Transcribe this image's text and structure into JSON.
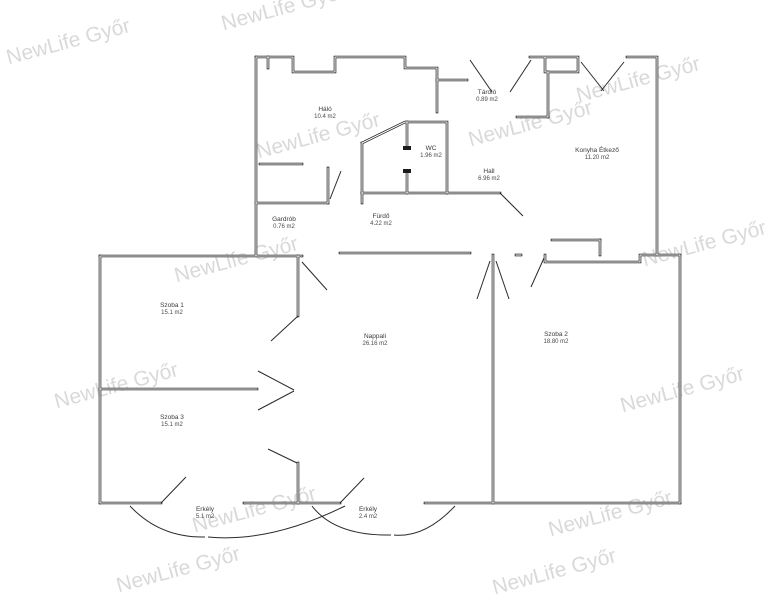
{
  "watermark": {
    "text": "NewLife Győr",
    "color": "#d9d9d9",
    "rotation_deg": -15,
    "positions": [
      {
        "x": 70,
        "y": 48
      },
      {
        "x": 285,
        "y": 14
      },
      {
        "x": 640,
        "y": 86
      },
      {
        "x": 320,
        "y": 142
      },
      {
        "x": 532,
        "y": 130
      },
      {
        "x": 238,
        "y": 266
      },
      {
        "x": 706,
        "y": 250
      },
      {
        "x": 118,
        "y": 392
      },
      {
        "x": 684,
        "y": 396
      },
      {
        "x": 256,
        "y": 516
      },
      {
        "x": 612,
        "y": 520
      },
      {
        "x": 180,
        "y": 576
      },
      {
        "x": 556,
        "y": 578
      }
    ]
  },
  "plan": {
    "background_color": "#ffffff",
    "wall_color": "#1c1c1c"
  },
  "rooms": [
    {
      "name": "Háló",
      "area": "10.4 m2",
      "x": 325,
      "y": 111
    },
    {
      "name": "Tároló",
      "area": "0.89 m2",
      "x": 487,
      "y": 94
    },
    {
      "name": "WC",
      "area": "1.96 m2",
      "x": 431,
      "y": 150
    },
    {
      "name": "Hall",
      "area": "6.96 m2",
      "x": 489,
      "y": 173
    },
    {
      "name": "Konyha Étkező",
      "area": "11.20 m2",
      "x": 597,
      "y": 152
    },
    {
      "name": "Gardrób",
      "area": "0.76 m2",
      "x": 284,
      "y": 221
    },
    {
      "name": "Fürdő",
      "area": "4.22 m2",
      "x": 381,
      "y": 218
    },
    {
      "name": "Szoba 1",
      "area": "15.1 m2",
      "x": 172,
      "y": 307
    },
    {
      "name": "Nappali",
      "area": "26.16 m2",
      "x": 375,
      "y": 338
    },
    {
      "name": "Szoba 2",
      "area": "18.80 m2",
      "x": 556,
      "y": 336
    },
    {
      "name": "Szoba 3",
      "area": "15.1 m2",
      "x": 172,
      "y": 419
    },
    {
      "name": "Erkély",
      "area": "5.1 m2",
      "x": 205,
      "y": 511
    },
    {
      "name": "Erkély",
      "area": "2.4 m2",
      "x": 368,
      "y": 511
    }
  ]
}
